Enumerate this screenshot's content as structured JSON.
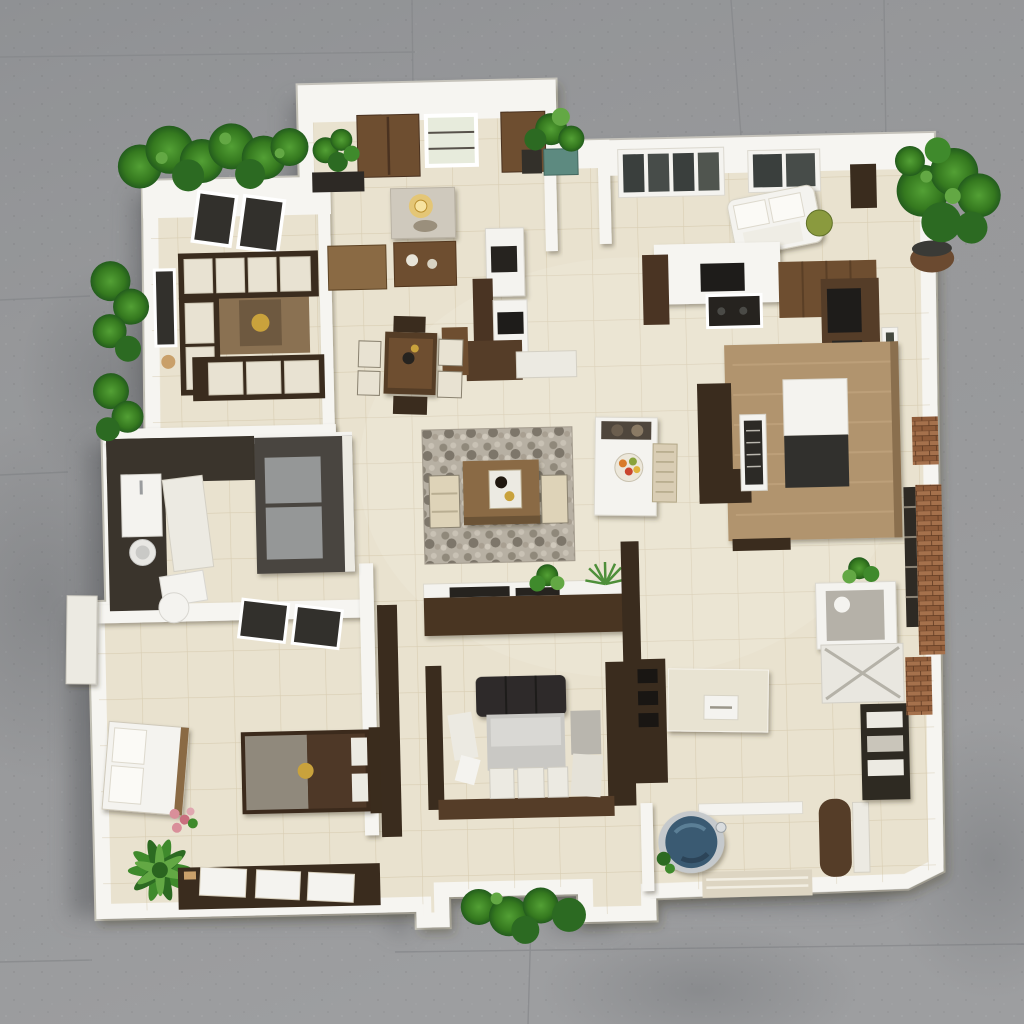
{
  "scene": {
    "description": "Aerial 3D render of a single-storey house floor plan model on gray concrete, white walls, beige tiled floors, wood furniture and green plants",
    "rooms": [
      {
        "name": "top-left-lounge",
        "items": [
          "corner-sofa",
          "brown-rug",
          "wall-skylights",
          "side-window"
        ]
      },
      {
        "name": "dressing-room",
        "items": [
          "wardrobe",
          "window",
          "door",
          "corner-plant",
          "marble-vanity",
          "lamp",
          "bench",
          "mirror-desk",
          "white-cabinet"
        ]
      },
      {
        "name": "foyer-tv-wall",
        "items": [
          "walnut-panel",
          "white-module",
          "tv-screen",
          "console",
          "side-table"
        ]
      },
      {
        "name": "central-dining",
        "items": [
          "dark-table",
          "four-chairs",
          "figurine"
        ]
      },
      {
        "name": "top-right-lounge",
        "items": [
          "white-chaise",
          "green-cushion",
          "wall-art",
          "window-strips"
        ]
      },
      {
        "name": "kitchen-north",
        "items": [
          "partition-tv",
          "cooktop",
          "brown-cabinets",
          "tall-cabinet",
          "wall-counter",
          "appliances",
          "wall-window"
        ]
      },
      {
        "name": "living-room",
        "items": [
          "pebble-rug",
          "coffee-table",
          "tray",
          "two-armchairs",
          "media-console",
          "console-plants"
        ]
      },
      {
        "name": "dining-table-white",
        "items": [
          "fruit-bowl",
          "bench-cushions",
          "wicker-chair"
        ]
      },
      {
        "name": "kitchen-island-area",
        "items": [
          "wood-island",
          "white-dark-module",
          "dark-sectional",
          "glass-display",
          "bench-bar"
        ]
      },
      {
        "name": "kitchen-west",
        "items": [
          "dark-counters",
          "sink",
          "washer",
          "white-box",
          "glass-cabinet",
          "laundry-basket",
          "south-windows"
        ]
      },
      {
        "name": "bedroom-southwest",
        "items": [
          "white-bench",
          "two-tone-bed",
          "gold-ornament",
          "headboard",
          "palm-plant",
          "pink-flowers",
          "walkway",
          "three-doormats"
        ]
      },
      {
        "name": "bedroom-south-center",
        "items": [
          "wood-rails",
          "charcoal-headrest",
          "gray-mattress",
          "pillows",
          "side-cushions",
          "tall-dark-unit"
        ]
      },
      {
        "name": "hall-divider",
        "items": [
          "walnut-divider",
          "walnut-bar",
          "cream-console"
        ]
      },
      {
        "name": "bathroom",
        "items": [
          "round-blue-tub",
          "chrome-rim",
          "faucet",
          "ledge",
          "striped-walkway",
          "walnut-counter",
          "white-box",
          "greenery"
        ]
      },
      {
        "name": "utility-east",
        "items": [
          "shower-cubicle",
          "x-front-panel",
          "dark-shelf-unit",
          "brick-strips",
          "ladder-shelf",
          "plant"
        ]
      }
    ],
    "exterior": [
      "concrete-ground",
      "expansion-seams",
      "house-shadow",
      "hedge-top-left",
      "bushes-west",
      "bushes-south",
      "potted-plant-north",
      "big-plant-east",
      "teal-planter",
      "wall-ledge-west"
    ]
  },
  "colors": {
    "ground": "#97989a",
    "groundLight": "#a3a4a6",
    "groundDark": "#808286",
    "shadow": "#54565a",
    "wall": "#f6f5f1",
    "wallEdge": "#c9c7bf",
    "floor": "#e9e2cf",
    "grout": "#c9bc9b",
    "white": "#f4f3ef",
    "offwhite": "#eceae2",
    "cream": "#e8e3d2",
    "cushion": "#e8e2d2",
    "mattress": "#c9c8c4",
    "marble": "#cfc9bd",
    "rugBrown": "#8a7152",
    "rugStone": "#b7b0a3",
    "woodDark": "#3a2c1e",
    "woodMid": "#6e4e30",
    "woodDeep": "#4a3423",
    "woodLight": "#b1946e",
    "walnut": "#553d28",
    "benchWood": "#8a6a44",
    "charcoal": "#26231f",
    "applianceDark": "#1e1c1a",
    "glass": "#32302c",
    "grayGlass": "#9a9c9c",
    "blanketGray": "#90897c",
    "blanketBrown": "#4e3827",
    "gold": "#c9a23c",
    "pink": "#d98f9a",
    "plantDark": "#2c6a22",
    "plantMid": "#3f8a2c",
    "plantLight": "#63a844",
    "teal": "#5d8a80",
    "tubBlue": "#3a5a72",
    "chrome": "#c5c9cc",
    "brick": "#a06c48"
  }
}
